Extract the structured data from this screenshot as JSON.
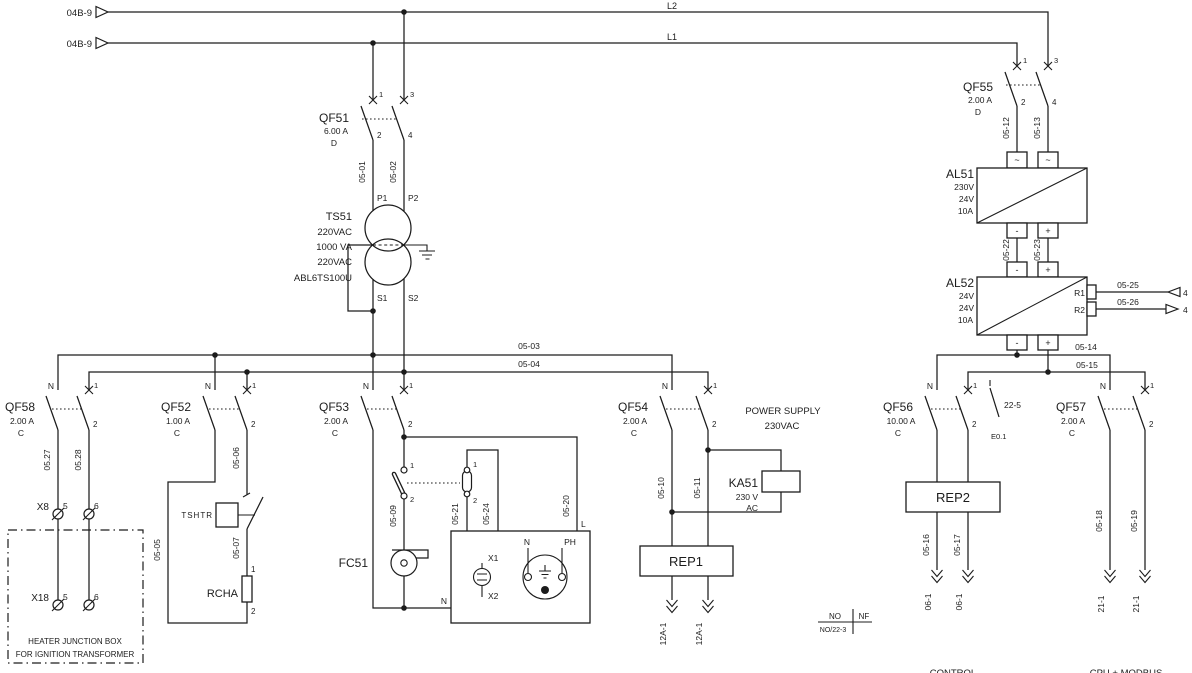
{
  "feed": {
    "ref_l2": "04B-9",
    "ref_l1": "04B-9",
    "l2": "L2",
    "l1": "L1"
  },
  "bus": {
    "n": "05-03",
    "l": "05-04"
  },
  "dcbus": {
    "m": "05-14",
    "p": "05-15"
  },
  "qf51": {
    "id": "QF51",
    "rating": "6.00 A",
    "curve": "D",
    "t1": "1",
    "t3": "3",
    "t2": "2",
    "t4": "4",
    "w1": "05-01",
    "w2": "05-02",
    "p1": "P1",
    "p2": "P2"
  },
  "ts51": {
    "id": "TS51",
    "prim": "220VAC",
    "power": "1000 VA",
    "sec": "220VAC",
    "model": "ABL6TS100U",
    "s1": "S1",
    "s2": "S2"
  },
  "qf58": {
    "id": "QF58",
    "rating": "2.00 A",
    "curve": "C",
    "n": "N",
    "t1": "1",
    "t2": "2",
    "w1": "05.27",
    "w2": "05.28",
    "x8": "X8",
    "x8_5": "5",
    "x8_6": "6",
    "x18": "X18",
    "x18_5": "5",
    "x18_6": "6",
    "box_line1": "HEATER JUNCTION BOX",
    "box_line2": "FOR IGNITION TRANSFORMER"
  },
  "qf52": {
    "id": "QF52",
    "rating": "1.00 A",
    "curve": "C",
    "n": "N",
    "t1": "1",
    "t2": "2",
    "w1": "05-06",
    "w_n": "05-05",
    "w2": "05-07",
    "tshtr": "TSHTR",
    "rcha": "RCHA",
    "r1": "1",
    "r2": "2"
  },
  "qf53": {
    "id": "QF53",
    "rating": "2.00 A",
    "curve": "C",
    "n": "N",
    "t1": "1",
    "t2": "2",
    "sw1_t1": "1",
    "sw1_t2": "2",
    "sw2_t1": "1",
    "sw2_t2": "2",
    "w_fan": "05-09",
    "w_lamp1": "05-21",
    "w_lamp2": "05-24",
    "w_line": "05-20",
    "line": "L",
    "neutral": "N",
    "fan": "FC51",
    "x1": "X1",
    "x2": "X2",
    "sock_n": "N",
    "sock_ph": "PH"
  },
  "qf54": {
    "id": "QF54",
    "rating": "2.00 A",
    "curve": "C",
    "n": "N",
    "t1": "1",
    "t2": "2",
    "w1": "05-10",
    "w2": "05-11",
    "title1": "POWER SUPPLY",
    "title2": "230VAC",
    "ka": {
      "id": "KA51",
      "volt": "230 V",
      "ac": "AC"
    },
    "rep": "REP1",
    "out1": "12A-1",
    "out2": "12A-1",
    "tbl_no": "NO",
    "tbl_nf": "NF",
    "tbl_ref": "NO/22-3"
  },
  "qf55": {
    "id": "QF55",
    "rating": "2.00 A",
    "curve": "D",
    "t1": "1",
    "t3": "3",
    "t2": "2",
    "t4": "4",
    "w1": "05-12",
    "w2": "05-13"
  },
  "al51": {
    "id": "AL51",
    "vin": "230V",
    "vout": "24V",
    "amp": "10A",
    "in1": "~",
    "in2": "~",
    "om": "-",
    "op": "+"
  },
  "link": {
    "w1": "05-22",
    "w2": "05-23"
  },
  "al52": {
    "id": "AL52",
    "vin": "24V",
    "vout": "24V",
    "amp": "10A",
    "im": "-",
    "ip": "+",
    "om": "-",
    "op": "+",
    "r1": "R1",
    "r2": "R2",
    "w_r1": "05-25",
    "w_r2": "05-26",
    "r1_ref": "4",
    "r2_ref": "4"
  },
  "qf56": {
    "id": "QF56",
    "rating": "10.00 A",
    "curve": "C",
    "n": "N",
    "t1": "1",
    "t2": "2",
    "aux": "22-5",
    "aux_ref": "E0.1",
    "rep": "REP2",
    "w1": "05-16",
    "w2": "05-17",
    "out1": "06-1",
    "out2": "06-1",
    "section": "CONTROL"
  },
  "qf57": {
    "id": "QF57",
    "rating": "2.00 A",
    "curve": "C",
    "n": "N",
    "t1": "1",
    "t2": "2",
    "w1": "05-18",
    "w2": "05-19",
    "out1": "21-1",
    "out2": "21-1",
    "section": "CPU + MODBUS"
  }
}
